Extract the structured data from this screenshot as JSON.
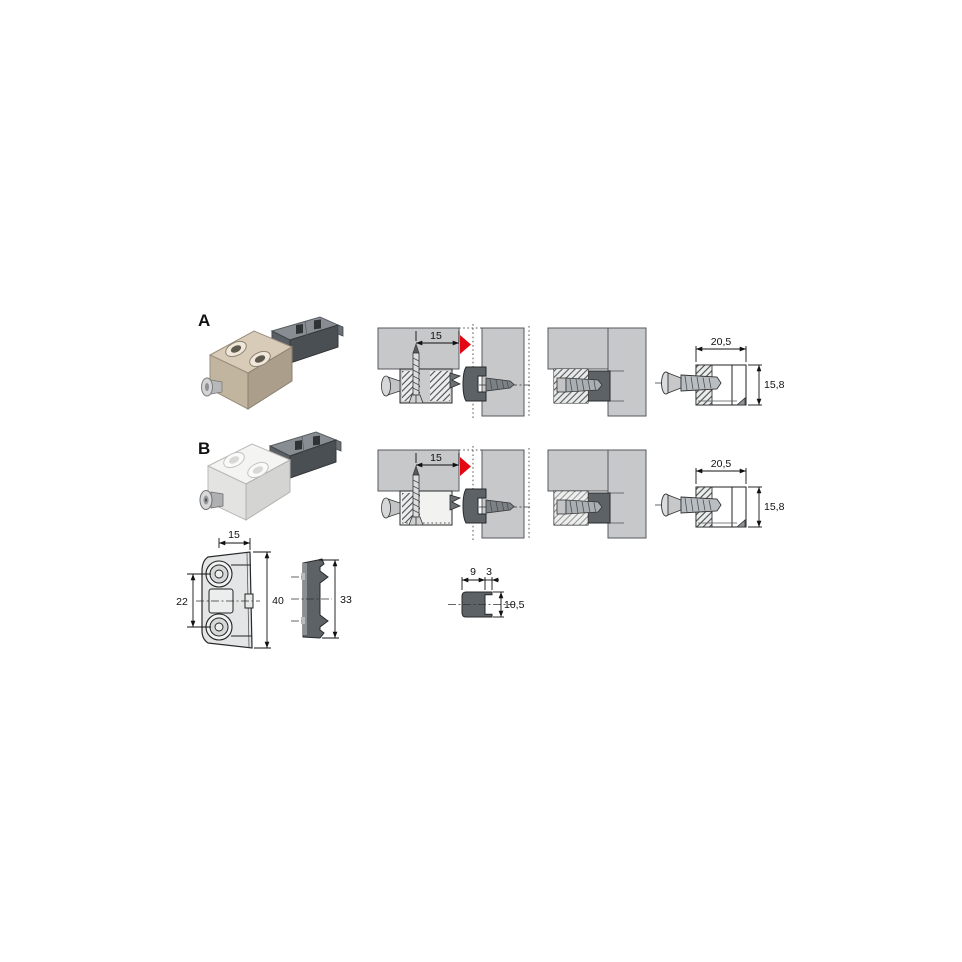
{
  "labels": {
    "product_a": "A",
    "product_b": "B"
  },
  "diagrams": {
    "row_a": {
      "install": {
        "edge_distance": "15"
      },
      "side_view": {
        "width": "20,5",
        "height": "15,8"
      }
    },
    "row_b": {
      "install": {
        "edge_distance": "15"
      },
      "side_view": {
        "width": "20,5",
        "height": "15,8"
      }
    },
    "front_view": {
      "top_width": "15",
      "hole_spacing": "22",
      "height": "40"
    },
    "insert_side_view": {
      "height": "33"
    },
    "insert_cross_section": {
      "body_width": "9",
      "lip_width": "3",
      "height": "10,5"
    }
  },
  "icons": {
    "direction_arrow": "red-triangle-right"
  },
  "colors": {
    "background": "#ffffff",
    "panel_gray": "#c6c8ca",
    "insert_dark_gray": "#5d6266",
    "arrow_red": "#e30613",
    "drawing_line": "#1a1a1a",
    "metal_body": "#cfc2ad",
    "plastic_body": "#f2f2f0"
  }
}
